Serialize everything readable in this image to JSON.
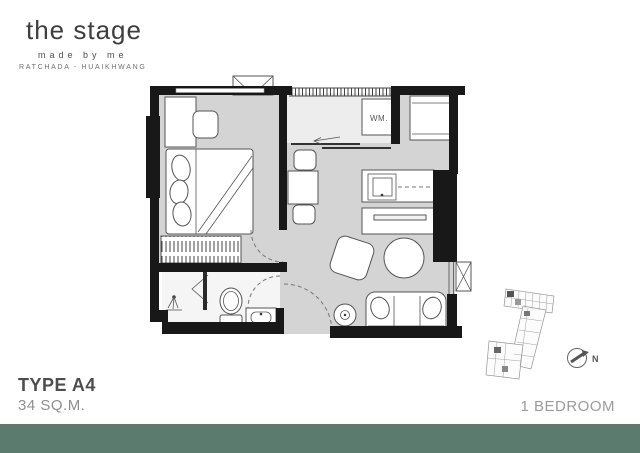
{
  "brand": {
    "name": "the stage",
    "tagline": "made by me",
    "location": "RATCHADA - HUAIKHWANG"
  },
  "floor_plan": {
    "washing_machine_label": "WM.",
    "compass_north_label": "N"
  },
  "footer": {
    "type_label": "TYPE A4",
    "area_label": "34 SQ.M.",
    "bedroom_label": "1 BEDROOM"
  },
  "colors": {
    "accent_band": "#5a7b6d",
    "wall": "#181818",
    "room_fill": "#d4d4d4",
    "balcony_fill": "#ededed",
    "bathroom_fill": "#f5f5f5"
  }
}
